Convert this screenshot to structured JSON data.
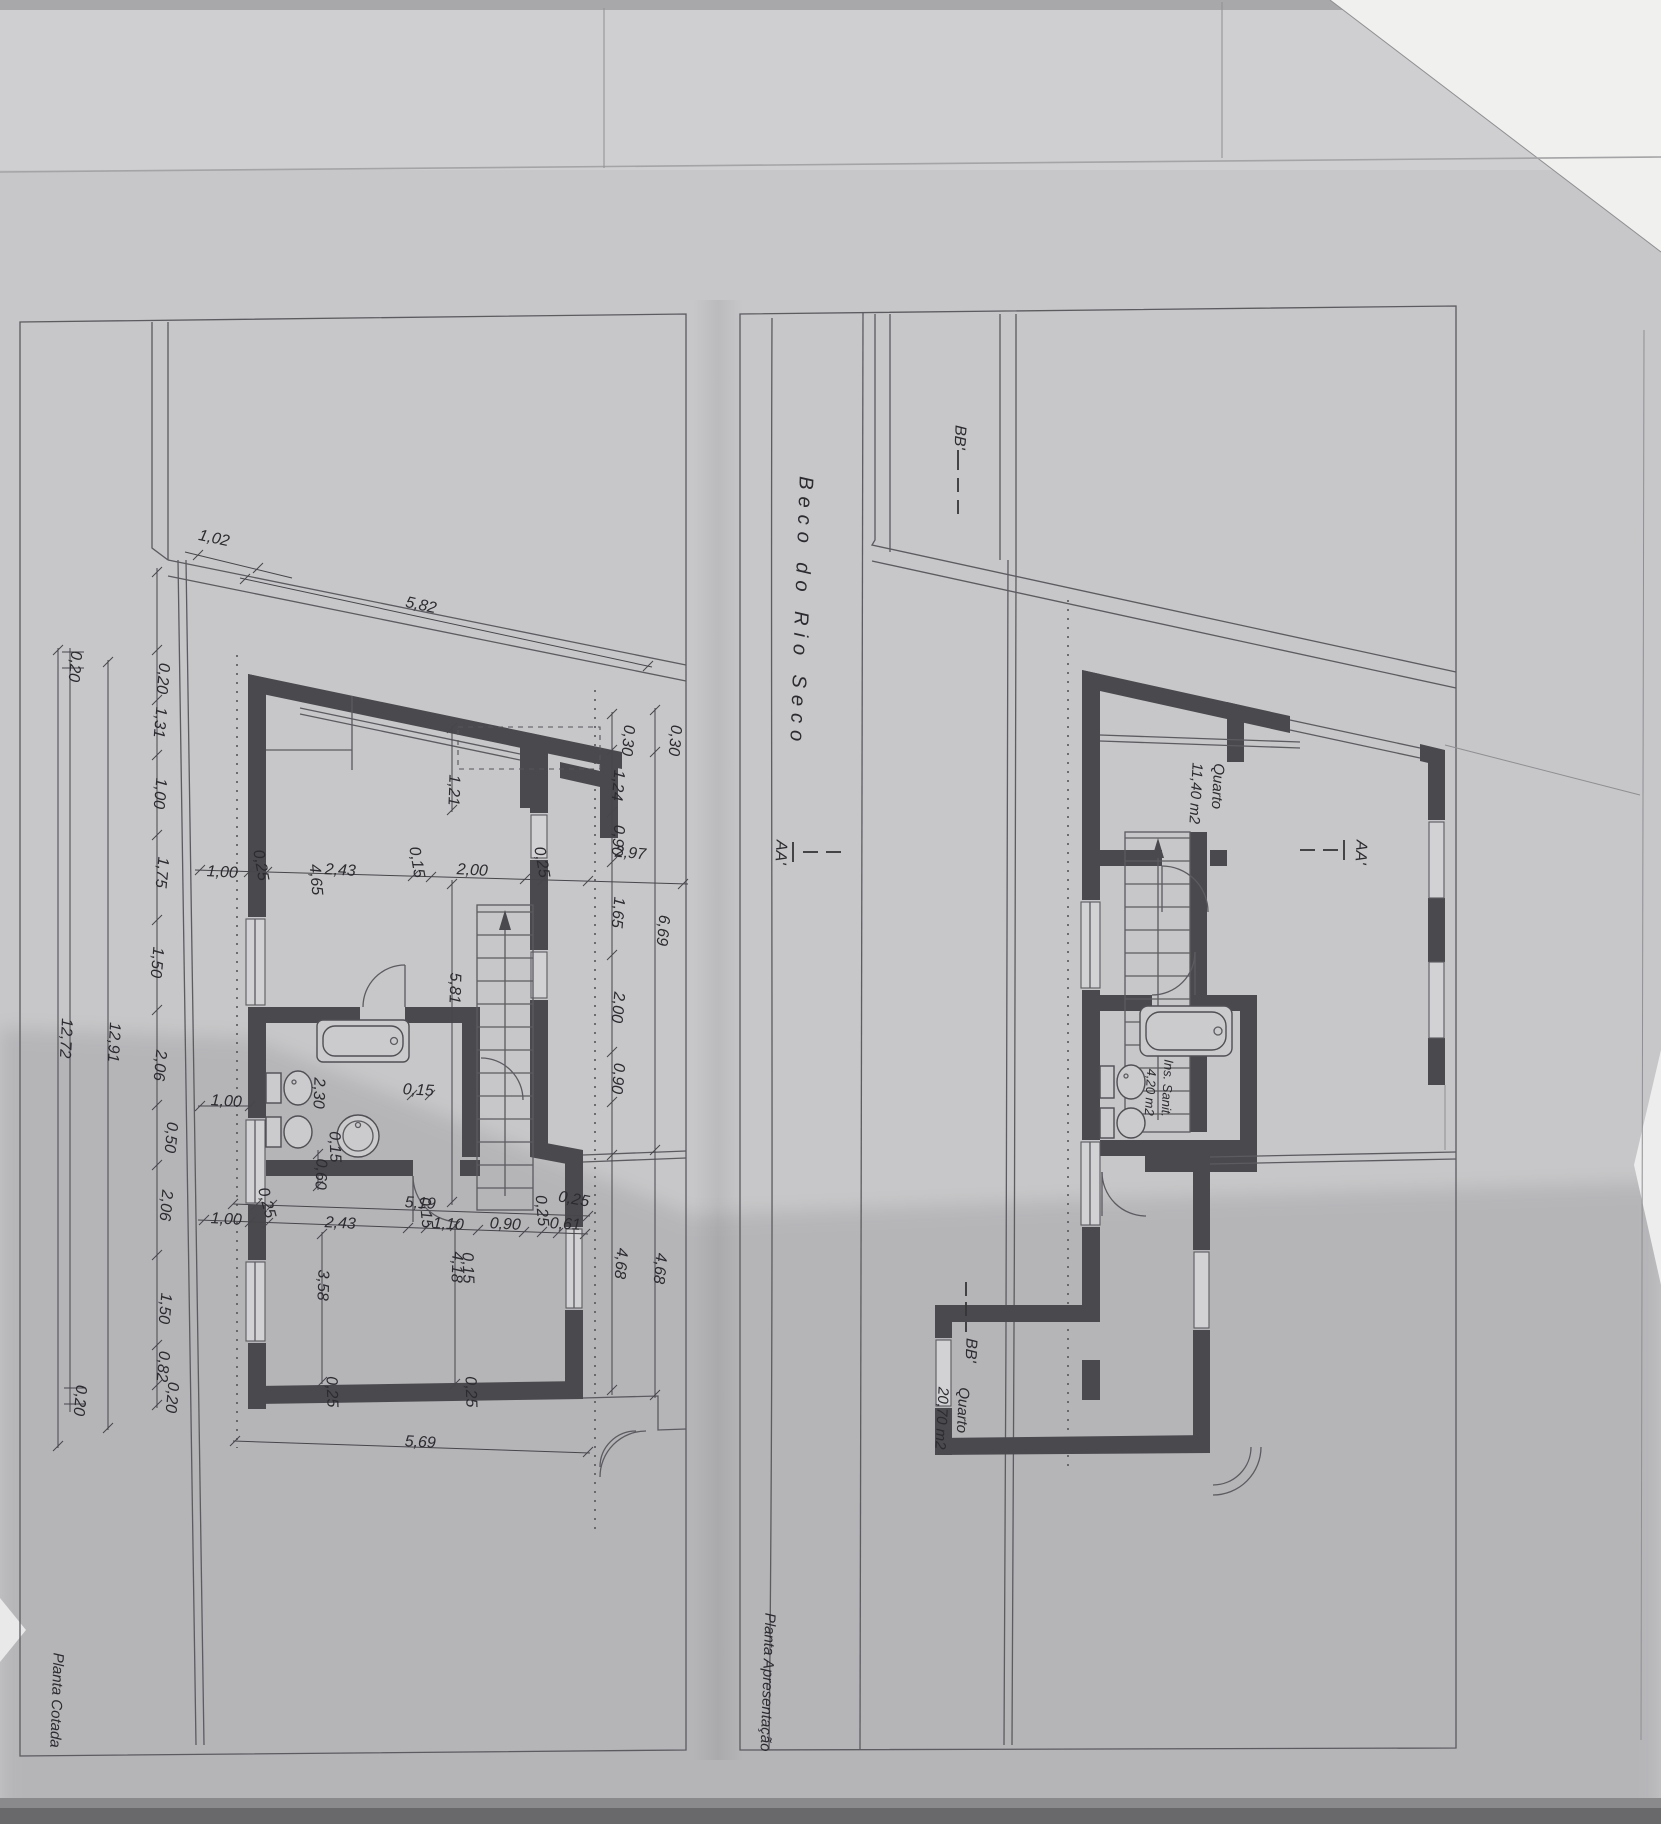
{
  "document": {
    "kind": "photographed architectural drawing, two floor plans side by side (sheet rotated 90°)",
    "street_name": "Beco do Rio Seco"
  },
  "plans": [
    {
      "id": "planta-cotada",
      "title": "Planta Cotada"
    },
    {
      "id": "planta-apresentacao",
      "title": "Planta Apresentação",
      "rooms": [
        {
          "name": "Quarto",
          "area": "11,40 m2"
        },
        {
          "name": "Ins. Sanit.",
          "area": "4,20 m2"
        },
        {
          "name": "Quarto",
          "area": "20,70 m2"
        }
      ],
      "section_markers": [
        "BB'",
        "AA'",
        "AA'",
        "BB'"
      ]
    }
  ],
  "dimensions_m": {
    "left_chain": [
      "0,20",
      "1,31",
      "1,00",
      "1,75",
      "1,50",
      "2,06",
      "0,50",
      "2,06",
      "1,50",
      "0,82",
      "0,20"
    ],
    "left_totals": [
      "12,91",
      "12,72",
      "0,20",
      "0,20"
    ],
    "top": [
      "1,02",
      "5,82"
    ],
    "upper_row": [
      "1,00",
      "0,25",
      "4,65",
      "2,43",
      "0,15",
      "2,00",
      "0,25",
      "2,97"
    ],
    "right_chain": [
      "0,30",
      "0,30",
      "1,24",
      "0,90",
      "1,65",
      "2,00",
      "0,90",
      "6,69",
      "4,68",
      "4,68"
    ],
    "middle": [
      "1,21",
      "5,81",
      "2,30",
      "1,00",
      "0,15",
      "0,60",
      "0,15"
    ],
    "lower_rows": [
      "1,00",
      "0,25",
      "5,19",
      "2,43",
      "0,15",
      "1,10",
      "0,90",
      "0,25",
      "0,61",
      "0,15"
    ],
    "bottom": [
      "3,58",
      "4,18",
      "0,25",
      "0,25",
      "0,25",
      "5,69"
    ]
  },
  "labels": [
    {
      "t": "1,02",
      "x": 213,
      "y": 543,
      "r": 12,
      "n": "dim-label"
    },
    {
      "t": "5,82",
      "x": 420,
      "y": 610,
      "r": 12,
      "n": "dim-label"
    },
    {
      "t": "0,20",
      "x": 158,
      "y": 678,
      "r": 95,
      "n": "dim-label"
    },
    {
      "t": "1,31",
      "x": 155,
      "y": 722,
      "r": 95,
      "n": "dim-label"
    },
    {
      "t": "1,00",
      "x": 155,
      "y": 793,
      "r": 95,
      "n": "dim-label"
    },
    {
      "t": "1,75",
      "x": 157,
      "y": 872,
      "r": 95,
      "n": "dim-label"
    },
    {
      "t": "1,50",
      "x": 152,
      "y": 962,
      "r": 95,
      "n": "dim-label"
    },
    {
      "t": "2,06",
      "x": 155,
      "y": 1065,
      "r": 95,
      "n": "dim-label"
    },
    {
      "t": "0,50",
      "x": 166,
      "y": 1137,
      "r": 95,
      "n": "dim-label"
    },
    {
      "t": "2,06",
      "x": 161,
      "y": 1205,
      "r": 95,
      "n": "dim-label"
    },
    {
      "t": "1,50",
      "x": 160,
      "y": 1308,
      "r": 95,
      "n": "dim-label"
    },
    {
      "t": "0,82",
      "x": 158,
      "y": 1366,
      "r": 95,
      "n": "dim-label"
    },
    {
      "t": "0,20",
      "x": 167,
      "y": 1397,
      "r": 95,
      "n": "dim-label"
    },
    {
      "t": "12,91",
      "x": 109,
      "y": 1042,
      "r": 93,
      "n": "dim-label"
    },
    {
      "t": "12,72",
      "x": 61,
      "y": 1038,
      "r": 93,
      "n": "dim-label"
    },
    {
      "t": "0,20",
      "x": 70,
      "y": 666,
      "r": 95,
      "n": "dim-label"
    },
    {
      "t": "0,20",
      "x": 75,
      "y": 1400,
      "r": 95,
      "n": "dim-label"
    },
    {
      "t": "1,00",
      "x": 222,
      "y": 877,
      "r": 3,
      "n": "dim-label"
    },
    {
      "t": "0,25",
      "x": 256,
      "y": 866,
      "r": 80,
      "n": "dim-label"
    },
    {
      "t": "4,65",
      "x": 311,
      "y": 880,
      "r": 85,
      "n": "dim-label"
    },
    {
      "t": "2,43",
      "x": 340,
      "y": 875,
      "r": 3,
      "n": "dim-label"
    },
    {
      "t": "0,15",
      "x": 412,
      "y": 863,
      "r": 80,
      "n": "dim-label"
    },
    {
      "t": "2,00",
      "x": 472,
      "y": 875,
      "r": 3,
      "n": "dim-label"
    },
    {
      "t": "0,25",
      "x": 537,
      "y": 863,
      "r": 80,
      "n": "dim-label"
    },
    {
      "t": "2,97",
      "x": 630,
      "y": 858,
      "r": 5,
      "n": "dim-label"
    },
    {
      "t": "1,21",
      "x": 449,
      "y": 790,
      "r": 92,
      "n": "dim-label"
    },
    {
      "t": "5,81",
      "x": 450,
      "y": 988,
      "r": 92,
      "n": "dim-label"
    },
    {
      "t": "0,30",
      "x": 623,
      "y": 740,
      "r": 95,
      "n": "dim-label"
    },
    {
      "t": "0,30",
      "x": 670,
      "y": 740,
      "r": 95,
      "n": "dim-label"
    },
    {
      "t": "1,24",
      "x": 613,
      "y": 785,
      "r": 95,
      "n": "dim-label"
    },
    {
      "t": "0,90",
      "x": 613,
      "y": 840,
      "r": 95,
      "n": "dim-label"
    },
    {
      "t": "1,65",
      "x": 613,
      "y": 912,
      "r": 95,
      "n": "dim-label"
    },
    {
      "t": "6,69",
      "x": 658,
      "y": 930,
      "r": 95,
      "n": "dim-label"
    },
    {
      "t": "2,00",
      "x": 613,
      "y": 1007,
      "r": 95,
      "n": "dim-label"
    },
    {
      "t": "0,90",
      "x": 613,
      "y": 1078,
      "r": 95,
      "n": "dim-label"
    },
    {
      "t": "4,68",
      "x": 616,
      "y": 1263,
      "r": 95,
      "n": "dim-label"
    },
    {
      "t": "4,68",
      "x": 655,
      "y": 1268,
      "r": 95,
      "n": "dim-label"
    },
    {
      "t": "2,30",
      "x": 314,
      "y": 1093,
      "r": 92,
      "n": "dim-label"
    },
    {
      "t": "1,00",
      "x": 226,
      "y": 1106,
      "r": 3,
      "n": "dim-label"
    },
    {
      "t": "0,15",
      "x": 418,
      "y": 1095,
      "r": 3,
      "n": "dim-label"
    },
    {
      "t": "0,25",
      "x": 262,
      "y": 1204,
      "r": 75,
      "n": "dim-label"
    },
    {
      "t": "5,19",
      "x": 420,
      "y": 1208,
      "r": 3,
      "n": "dim-label"
    },
    {
      "t": "1,00",
      "x": 226,
      "y": 1224,
      "r": 3,
      "n": "dim-label"
    },
    {
      "t": "2,43",
      "x": 340,
      "y": 1228,
      "r": 3,
      "n": "dim-label"
    },
    {
      "t": "0,15",
      "x": 421,
      "y": 1213,
      "r": 85,
      "n": "dim-label"
    },
    {
      "t": "1,10",
      "x": 448,
      "y": 1229,
      "r": 3,
      "n": "dim-label"
    },
    {
      "t": "0,90",
      "x": 505,
      "y": 1229,
      "r": 3,
      "n": "dim-label"
    },
    {
      "t": "0,25",
      "x": 537,
      "y": 1211,
      "r": 85,
      "n": "dim-label"
    },
    {
      "t": "0,61",
      "x": 565,
      "y": 1229,
      "r": 3,
      "n": "dim-label"
    },
    {
      "t": "0,15",
      "x": 330,
      "y": 1147,
      "r": 88,
      "n": "dim-label"
    },
    {
      "t": "0,60",
      "x": 316,
      "y": 1174,
      "r": 92,
      "n": "dim-label"
    },
    {
      "t": "0,15",
      "x": 463,
      "y": 1268,
      "r": 88,
      "n": "dim-label"
    },
    {
      "t": "3,58",
      "x": 318,
      "y": 1285,
      "r": 92,
      "n": "dim-label"
    },
    {
      "t": "4,18",
      "x": 452,
      "y": 1267,
      "r": 92,
      "n": "dim-label"
    },
    {
      "t": "0,25",
      "x": 327,
      "y": 1392,
      "r": 88,
      "n": "dim-label"
    },
    {
      "t": "0,25",
      "x": 466,
      "y": 1392,
      "r": 88,
      "n": "dim-label"
    },
    {
      "t": "0,25",
      "x": 573,
      "y": 1204,
      "r": 10,
      "n": "dim-label"
    },
    {
      "t": "5,69",
      "x": 420,
      "y": 1447,
      "r": 3,
      "n": "dim-label"
    },
    {
      "t": "Quarto",
      "x": 1213,
      "y": 786,
      "r": 93,
      "s": 15,
      "n": "room-label"
    },
    {
      "t": "11,40 m2",
      "x": 1191,
      "y": 793,
      "r": 93,
      "s": 15,
      "n": "room-area-label"
    },
    {
      "t": "Ins. Sanit.",
      "x": 1163,
      "y": 1088,
      "r": 93,
      "s": 13,
      "n": "room-label"
    },
    {
      "t": "4,20 m2",
      "x": 1146,
      "y": 1092,
      "r": 93,
      "s": 13,
      "n": "room-area-label"
    },
    {
      "t": "Quarto",
      "x": 958,
      "y": 1410,
      "r": 93,
      "s": 15,
      "n": "room-label"
    },
    {
      "t": "20,70 m2",
      "x": 937,
      "y": 1418,
      "r": 93,
      "s": 15,
      "n": "room-area-label"
    },
    {
      "t": "Beco do Rio Seco",
      "x": 795,
      "y": 612,
      "r": 92,
      "s": 20,
      "ls": 7,
      "n": "street-label"
    },
    {
      "t": "BB'",
      "x": 955,
      "y": 437,
      "r": 93,
      "s": 16,
      "n": "section-marker"
    },
    {
      "t": "AA'",
      "x": 776,
      "y": 852,
      "r": 93,
      "s": 16,
      "n": "section-marker"
    },
    {
      "t": "AA'",
      "x": 1356,
      "y": 852,
      "r": 93,
      "s": 16,
      "n": "section-marker"
    },
    {
      "t": "BB'",
      "x": 966,
      "y": 1350,
      "r": 93,
      "s": 16,
      "n": "section-marker"
    },
    {
      "t": "Planta Cotada",
      "x": 52,
      "y": 1700,
      "r": 92,
      "s": 15,
      "n": "plan-title"
    },
    {
      "t": "Planta Apresentação",
      "x": 763,
      "y": 1682,
      "r": 92,
      "s": 15,
      "n": "plan-title"
    }
  ]
}
